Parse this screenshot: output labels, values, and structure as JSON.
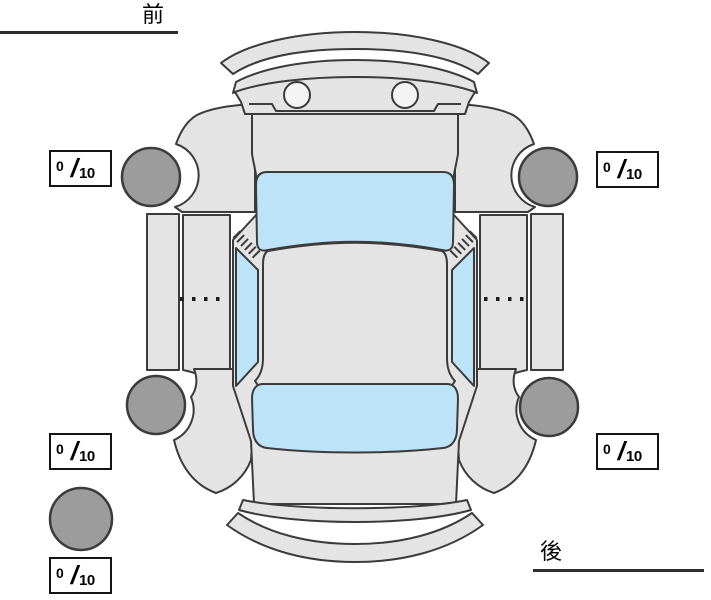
{
  "labels": {
    "front": "前",
    "rear": "後"
  },
  "scores": [
    {
      "position": "front-left",
      "value": "0",
      "separator": "/",
      "max": "10"
    },
    {
      "position": "front-right",
      "value": "0",
      "separator": "/",
      "max": "10"
    },
    {
      "position": "rear-left",
      "value": "0",
      "separator": "/",
      "max": "10"
    },
    {
      "position": "rear-right",
      "value": "0",
      "separator": "/",
      "max": "10"
    },
    {
      "position": "spare",
      "value": "0",
      "separator": "/",
      "max": "10"
    }
  ],
  "colors": {
    "body": "#e4e4e4",
    "window": "#bce3f8",
    "tire": "#9c9c9c",
    "outline": "#3b3b3b",
    "detail": "#f4f4f4"
  }
}
